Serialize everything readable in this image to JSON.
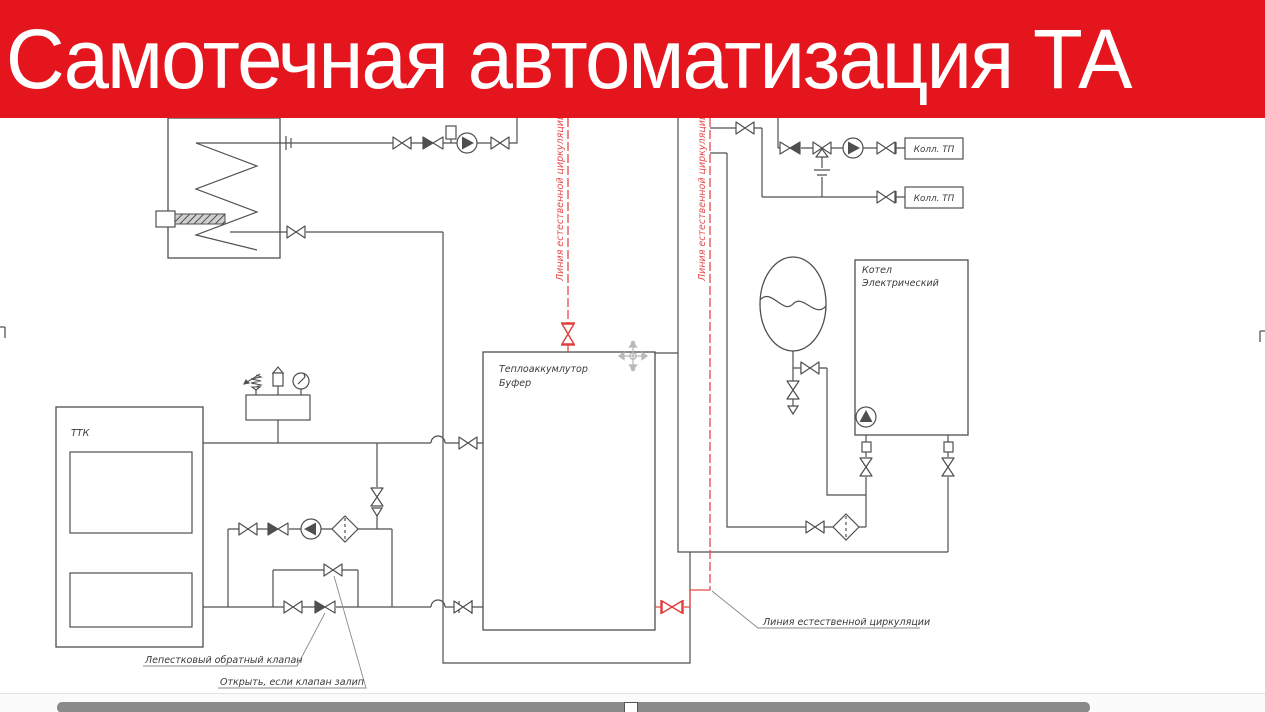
{
  "banner": {
    "title": "Самотечная автоматизация ТА"
  },
  "labels": {
    "ttk": "ТТК",
    "buffer1": "Теплоаккумлутор",
    "buffer2": "Буфер",
    "boiler1": "Котел",
    "boiler2": "Электрический",
    "collector1": "Колл. ТП",
    "collector2": "Колл. ТП"
  },
  "annotations": {
    "nat_left": "Линия естественной циркуляции",
    "nat_right": "Линия естественной циркуляции",
    "nat_callout": "Линия естественной циркуляции",
    "petal": "Лепестковый обратный клапан",
    "open_stuck": "Открыть, если клапан залип"
  },
  "colors": {
    "banner_bg": "#e4151c",
    "banner_fg": "#ffffff",
    "pipe": "#4f4f4f",
    "red_line": "#e64a4a",
    "label_text": "#3a3a3a",
    "move_icon": "#b9b9b9",
    "scrollbar_thumb": "#8a8a8a"
  },
  "icons": {
    "valve": "bowtie",
    "check_valve": "half-filled-bowtie",
    "three_way_valve": "bowtie-with-branch",
    "pump": "circle-with-triangle",
    "filter": "diamond-dashed",
    "pressure_gauge": "circle-needle",
    "safety_valve": "spring-arrow",
    "air_vent": "box-triangle",
    "expansion_tank": "oval-membrane",
    "move": "four-way-arrows"
  }
}
